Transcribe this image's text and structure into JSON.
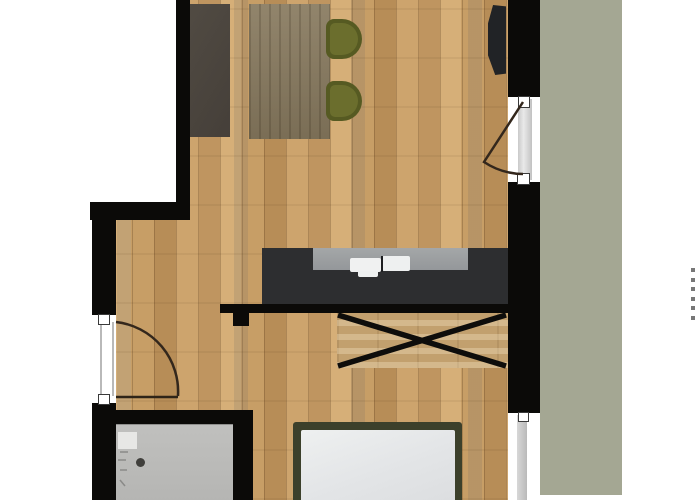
{
  "document": {
    "type": "architectural-floor-plan",
    "title": "Studio apartment floor plan (top-down view)",
    "visible_text": "",
    "notes": "No readable text rendered in the plan; faint cropped tick marks along right edge"
  },
  "colors": {
    "background": "#ffffff",
    "walls": "#0b0a08",
    "wood_floor": "#c69d66",
    "balcony": "#a4a793",
    "bathroom_floor": "#b9b9b7",
    "kitchen_counter": "#2d2e30",
    "countertop": "#9c9fa0",
    "sink": "#f0f1f1",
    "dining_table": "#887a5f",
    "chairs_olive": "#6b6e2d",
    "sideboard": "#4c463f",
    "tv": "#212326",
    "bed_frame": "#3c402b",
    "mattress": "#eaecee"
  },
  "rooms": [
    {
      "name": "living-dining-area",
      "floor": "wood"
    },
    {
      "name": "kitchenette",
      "floor": "wood"
    },
    {
      "name": "sleeping-area",
      "floor": "wood"
    },
    {
      "name": "bathroom",
      "floor": "gray-tile"
    },
    {
      "name": "balcony",
      "floor": "green"
    }
  ],
  "furniture": [
    "sideboard",
    "dining-table",
    "dining-chair",
    "dining-chair",
    "wall-mounted-tv",
    "kitchen-counter-with-double-sink",
    "crossed-storage-unit",
    "double-bed-with-mattress",
    "shower-tray",
    "floor-drain"
  ],
  "openings": [
    {
      "name": "entrance-door",
      "wall": "left",
      "swing": "inward"
    },
    {
      "name": "balcony-door",
      "wall": "right",
      "swing": "inward"
    },
    {
      "name": "window",
      "wall": "right-bottom"
    }
  ]
}
